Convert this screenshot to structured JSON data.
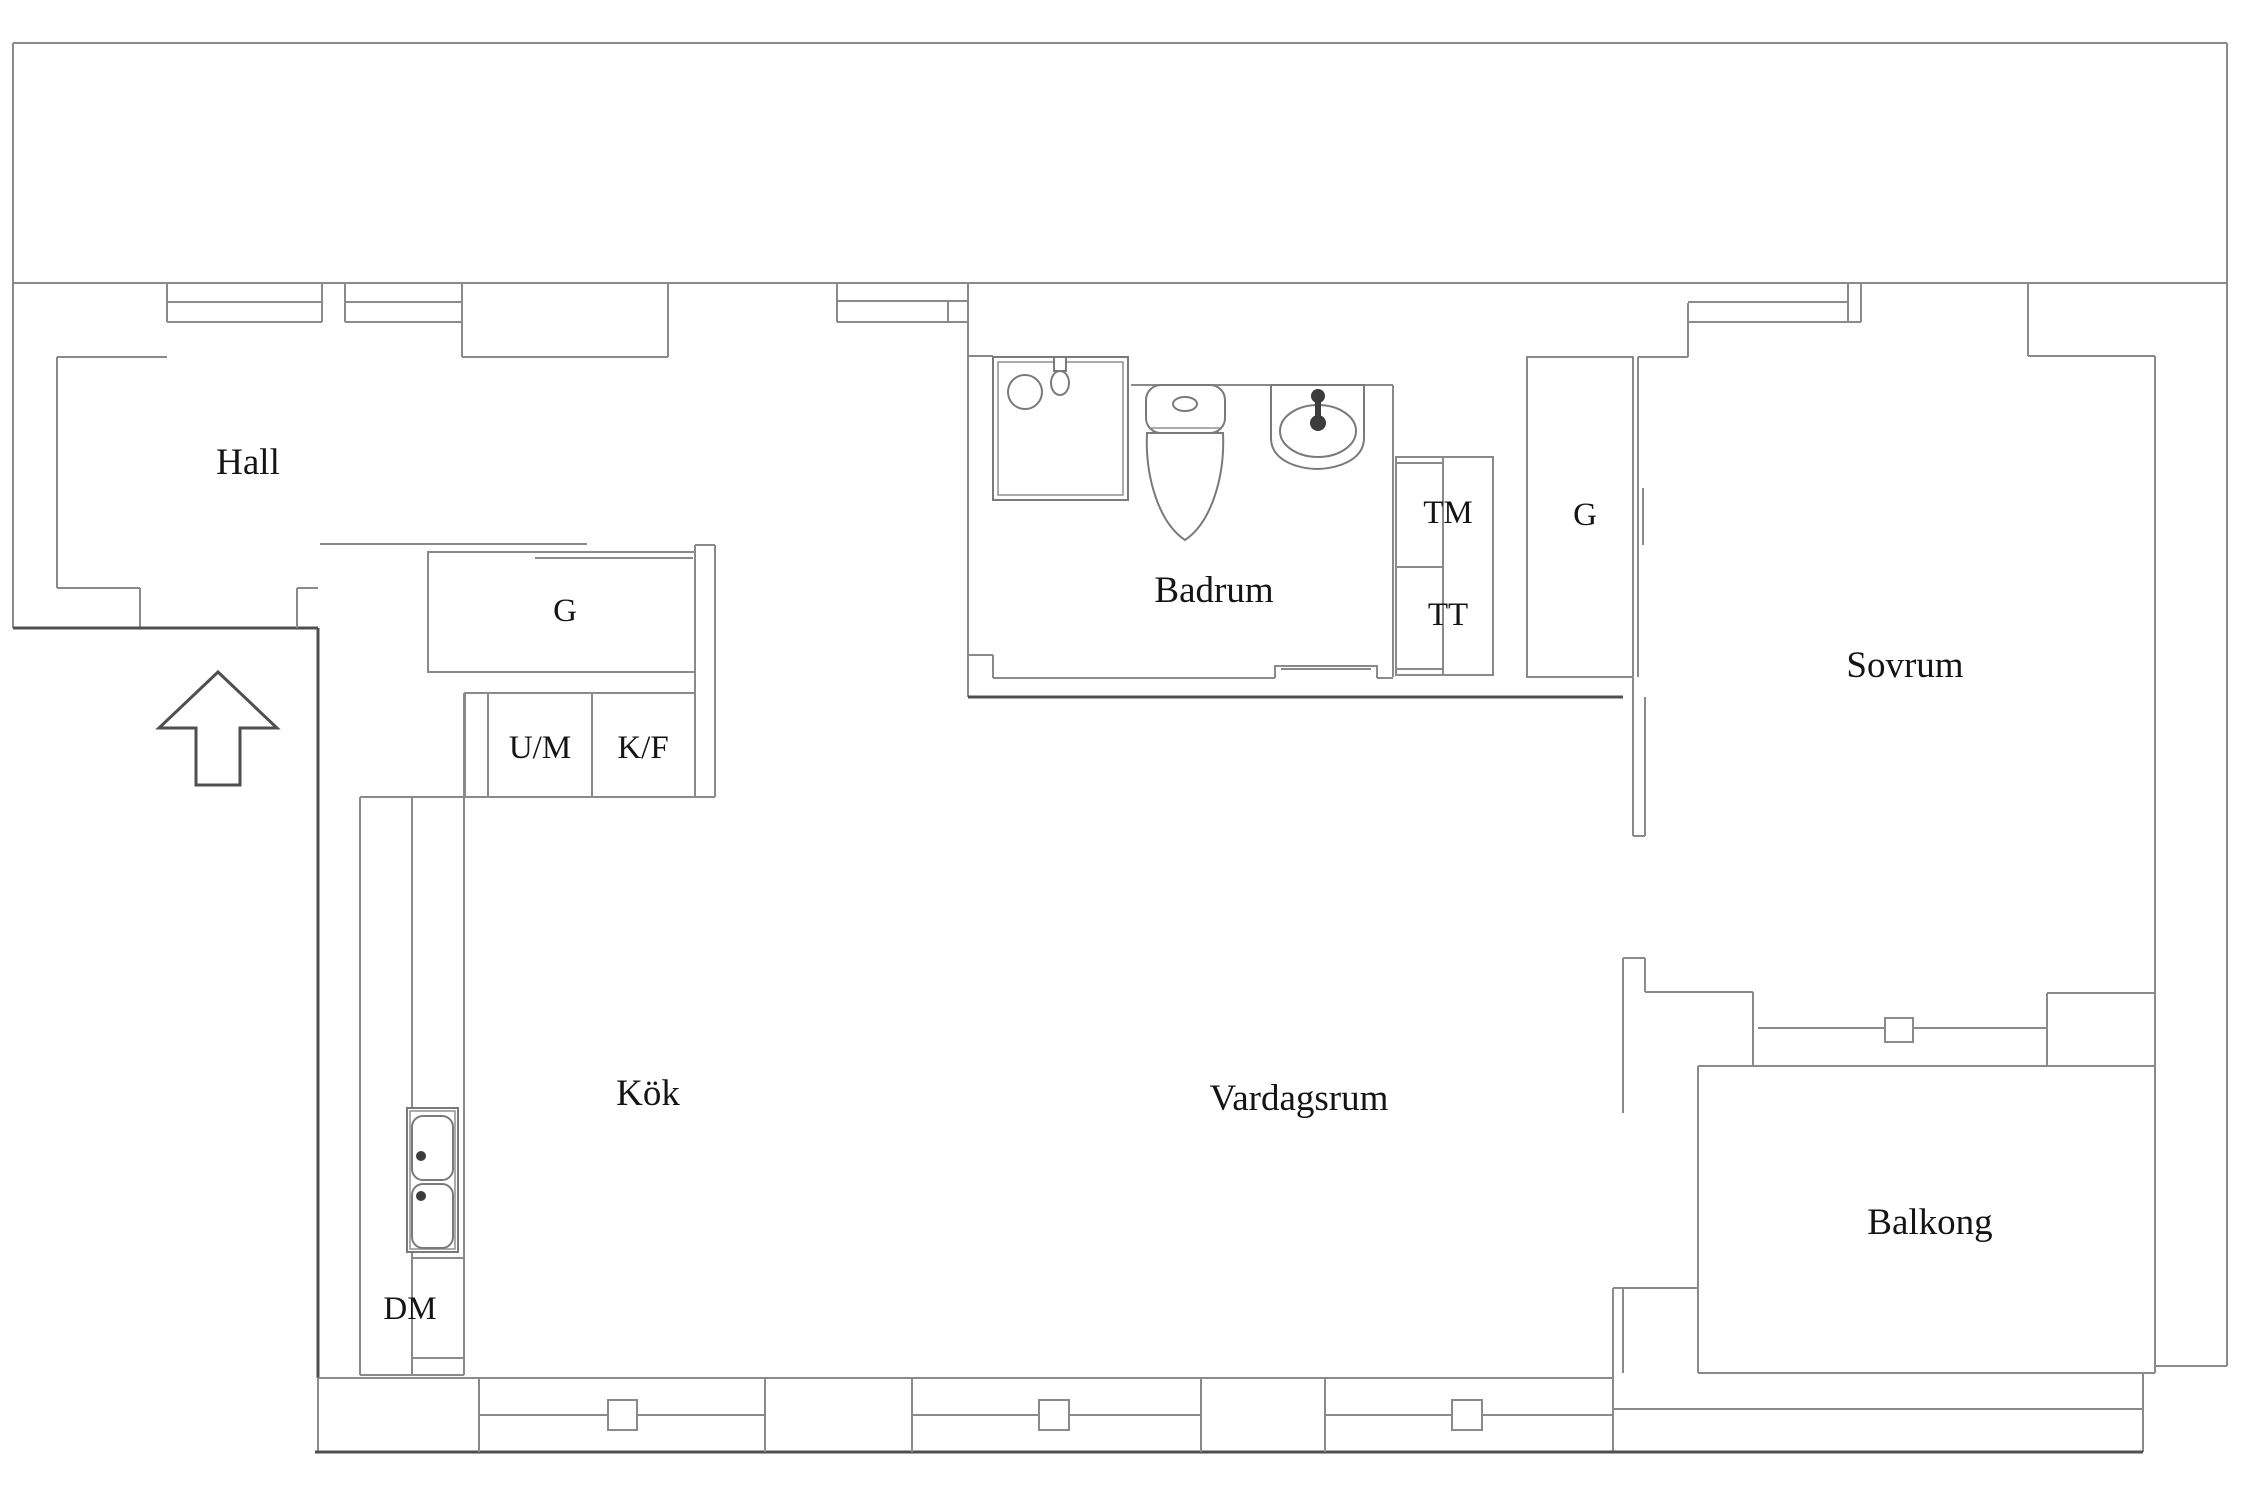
{
  "floorplan": {
    "type": "apartment-floor-plan",
    "language": "Swedish",
    "rooms": {
      "hall": "Hall",
      "badrum": "Badrum",
      "sovrum": "Sovrum",
      "kok": "Kök",
      "vardagsrum": "Vardagsrum",
      "balkong": "Balkong"
    },
    "units": {
      "garderob_kok": "G",
      "garderob_sovrum": "G",
      "um": "U/M",
      "kf": "K/F",
      "tm": "TM",
      "tt": "TT",
      "dm": "DM"
    },
    "icons": {
      "entrance_arrow": "entrance-arrow-up",
      "shower": "shower-cabin",
      "toilet": "toilet",
      "sink_bathroom": "wash-basin",
      "sink_kitchen": "double-bowl-sink"
    },
    "colors": {
      "background": "#ffffff",
      "wall_line": "#8a8a8a",
      "wall_dark": "#4f4f4f",
      "text": "#141414"
    }
  }
}
